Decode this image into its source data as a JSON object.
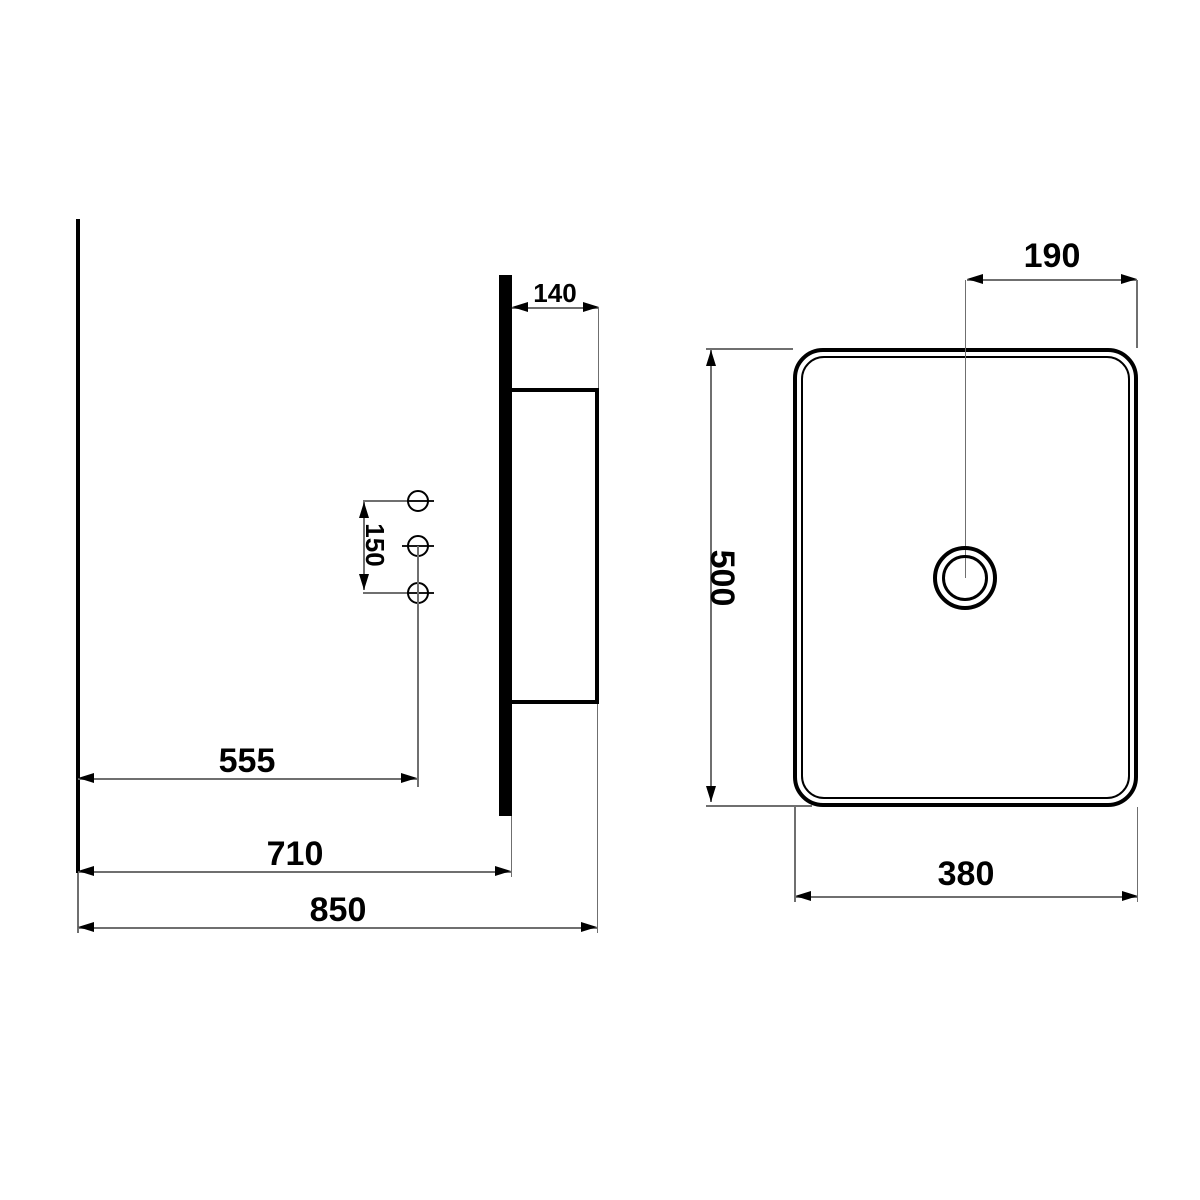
{
  "drawing": {
    "type": "technical-installation-drawing",
    "views": {
      "side_view": {
        "dim_wall_to_edge_top": "140",
        "dim_hole_spacing": "150",
        "dim_wall_to_holes": "555",
        "dim_wall_to_bracket": "710",
        "dim_overall": "850"
      },
      "top_view": {
        "dim_drain_to_edge": "190",
        "dim_depth": "500",
        "dim_width": "380"
      }
    }
  }
}
